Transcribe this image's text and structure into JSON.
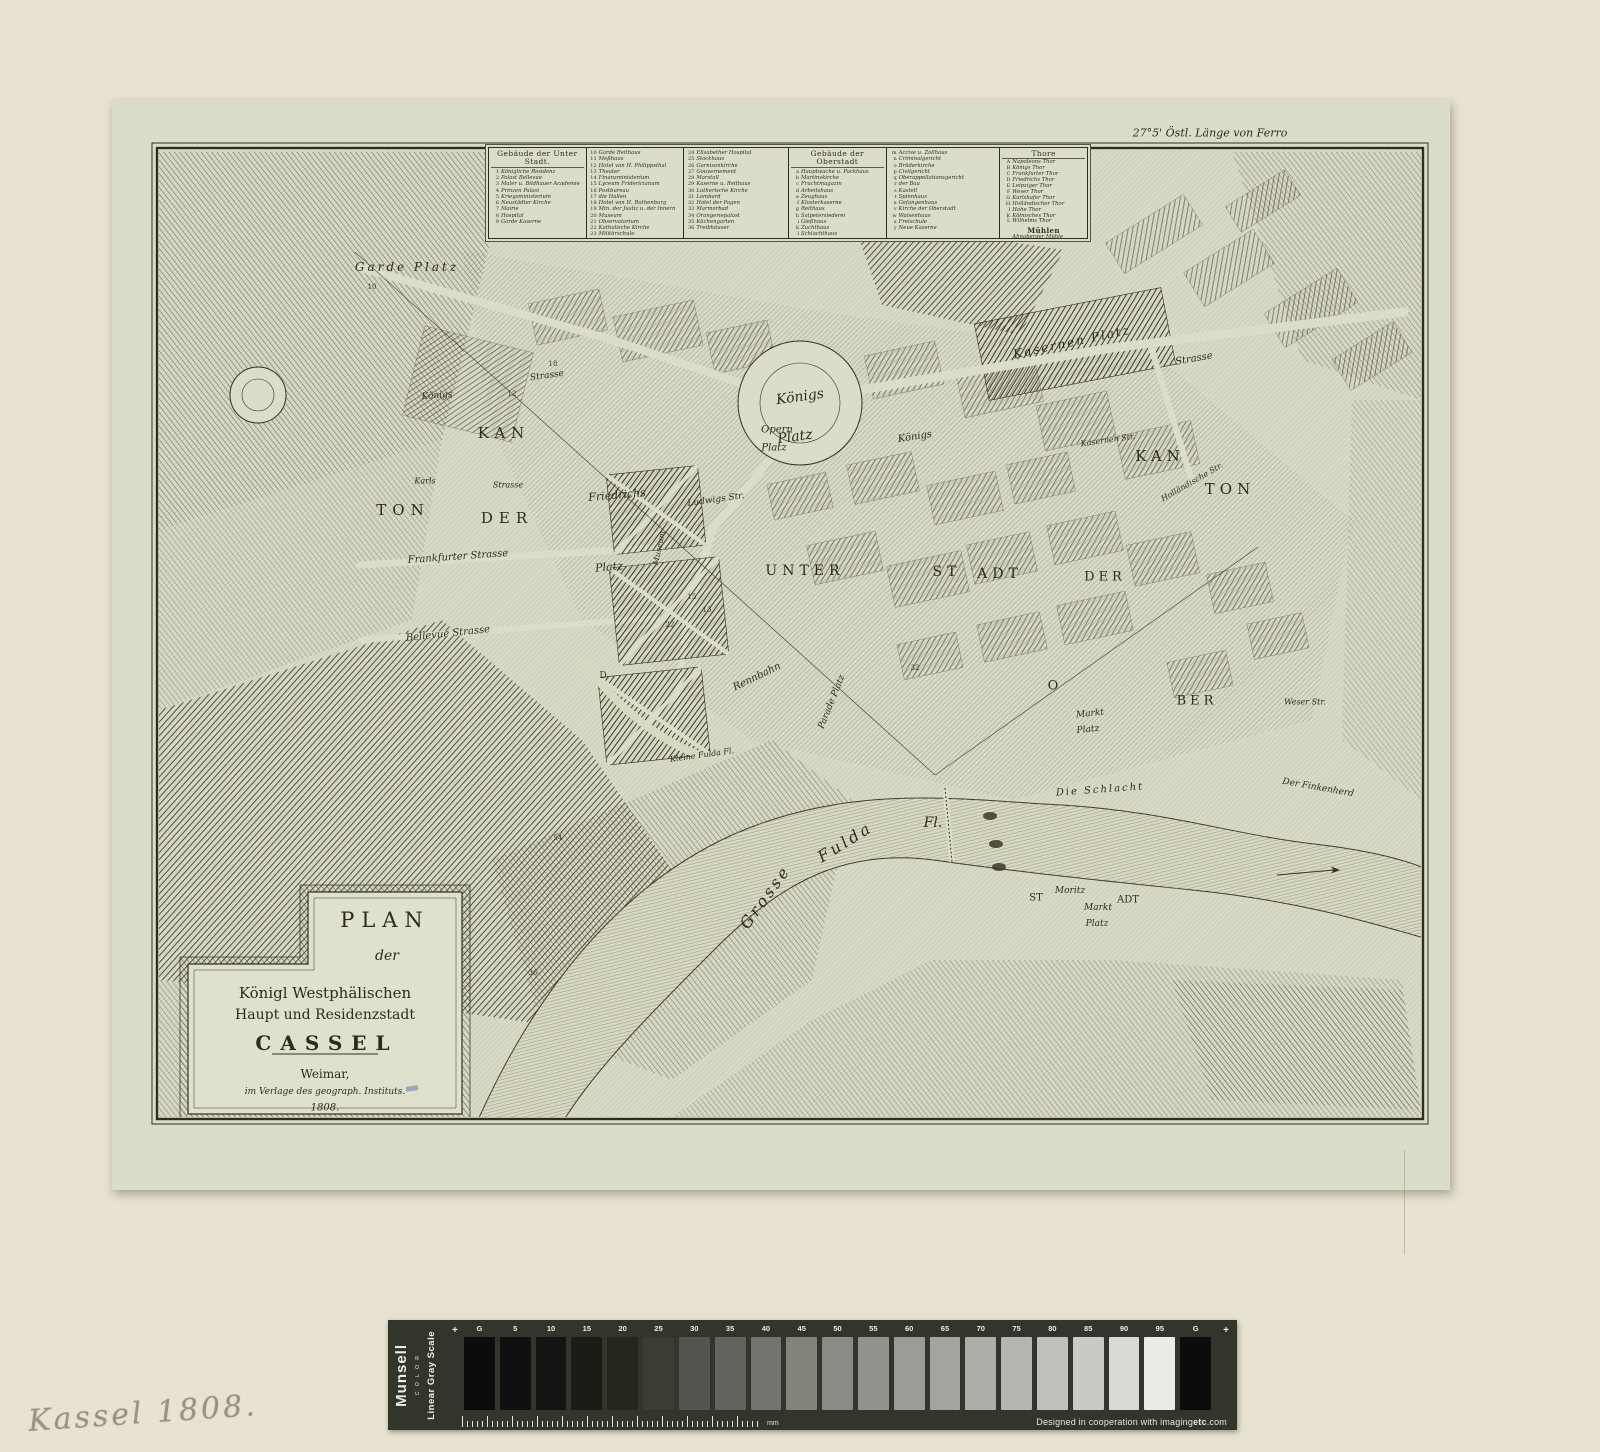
{
  "artifact": {
    "handwritten_note": "Kassel 1808.",
    "corner_note": "27°5' Östl. Länge von Ferro"
  },
  "legend": {
    "columns": [
      {
        "header": "Gebäude der Unter Stadt.",
        "items": [
          {
            "k": "1",
            "v": "Königliche Residenz"
          },
          {
            "k": "2",
            "v": "Palast Bellevue"
          },
          {
            "k": "3",
            "v": "Maler u. Bildhauer Academie"
          },
          {
            "k": "4",
            "v": "Prinzen Palast"
          },
          {
            "k": "5",
            "v": "Kriegsministerium"
          },
          {
            "k": "6",
            "v": "Neustädter Kirche"
          },
          {
            "k": "7",
            "v": "Mairie"
          },
          {
            "k": "8",
            "v": "Hospital"
          },
          {
            "k": "9",
            "v": "Garde Kaserne"
          }
        ]
      },
      {
        "header": "",
        "items": [
          {
            "k": "10",
            "v": "Garde Reithaus"
          },
          {
            "k": "11",
            "v": "Meßhaus"
          },
          {
            "k": "12",
            "v": "Hotel von H. Philippsthal"
          },
          {
            "k": "13",
            "v": "Theater"
          },
          {
            "k": "14",
            "v": "Finanzministerium"
          },
          {
            "k": "15",
            "v": "Lyceum Fridericianum"
          },
          {
            "k": "16",
            "v": "Postbureau"
          },
          {
            "k": "17",
            "v": "die Hallen"
          },
          {
            "k": "18",
            "v": "Hotel von H. Rothenburg"
          },
          {
            "k": "19",
            "v": "Min. der Justiz u. der Innern"
          },
          {
            "k": "20",
            "v": "Museum"
          },
          {
            "k": "21",
            "v": "Observatorium"
          },
          {
            "k": "22",
            "v": "Katholische Kirche"
          },
          {
            "k": "23",
            "v": "Militärschule"
          }
        ]
      },
      {
        "header": "",
        "items": [
          {
            "k": "24",
            "v": "Elisabether Hospital"
          },
          {
            "k": "25",
            "v": "Stockhaus"
          },
          {
            "k": "26",
            "v": "Garnisonkirche"
          },
          {
            "k": "27",
            "v": "Gouvernement"
          },
          {
            "k": "28",
            "v": "Marstall"
          },
          {
            "k": "29",
            "v": "Kaserne u. Reithaus"
          },
          {
            "k": "30",
            "v": "Lutherische Kirche"
          },
          {
            "k": "31",
            "v": "Lombard"
          },
          {
            "k": "32",
            "v": "Hotel der Pagen"
          },
          {
            "k": "33",
            "v": "Marmorbad"
          },
          {
            "k": "34",
            "v": "Orangeriepalast"
          },
          {
            "k": "35",
            "v": "Küchengarten"
          },
          {
            "k": "36",
            "v": "Treibhäuser"
          }
        ]
      },
      {
        "header": "Gebäude der Oberstadt",
        "items": [
          {
            "k": "a",
            "v": "Hauptwache u. Packhaus"
          },
          {
            "k": "b",
            "v": "Martinskirche"
          },
          {
            "k": "c",
            "v": "Fruchtmagazin"
          },
          {
            "k": "d",
            "v": "Arbeitshaus"
          },
          {
            "k": "e",
            "v": "Zeughaus"
          },
          {
            "k": "f",
            "v": "Klosterkaserne"
          },
          {
            "k": "g",
            "v": "Reithaus"
          },
          {
            "k": "h",
            "v": "Salpetersiederei"
          },
          {
            "k": "i",
            "v": "Gießhaus"
          },
          {
            "k": "k",
            "v": "Zuchthaus"
          },
          {
            "k": "l",
            "v": "Schlachthaus"
          }
        ]
      },
      {
        "header": "",
        "items": [
          {
            "k": "m",
            "v": "Accise u. Zollhaus"
          },
          {
            "k": "n",
            "v": "Criminalgericht"
          },
          {
            "k": "o",
            "v": "Brüderkirche"
          },
          {
            "k": "p",
            "v": "Civilgericht"
          },
          {
            "k": "q",
            "v": "Oberappellationsgericht"
          },
          {
            "k": "r",
            "v": "der Bau"
          },
          {
            "k": "s",
            "v": "Kastell"
          },
          {
            "k": "t",
            "v": "Spinnhaus"
          },
          {
            "k": "u",
            "v": "Gefangenhaus"
          },
          {
            "k": "v",
            "v": "Kirche der Oberstadt"
          },
          {
            "k": "w",
            "v": "Waisenhaus"
          },
          {
            "k": "x",
            "v": "Freischule"
          },
          {
            "k": "y",
            "v": "Neue Kaserne"
          }
        ]
      },
      {
        "header": "Thore",
        "items": [
          {
            "k": "A",
            "v": "Napoleons Thor"
          },
          {
            "k": "B",
            "v": "Königs Thor"
          },
          {
            "k": "C",
            "v": "Frankfurter Thor"
          },
          {
            "k": "D",
            "v": "Friedrichs Thor"
          },
          {
            "k": "E",
            "v": "Leipziger Thor"
          },
          {
            "k": "F",
            "v": "Weser Thor"
          },
          {
            "k": "G",
            "v": "Karlshafer Thor"
          },
          {
            "k": "H",
            "v": "Holländischer Thor"
          },
          {
            "k": "I",
            "v": "Hohe Thor"
          },
          {
            "k": "K",
            "v": "Kölnisches Thor"
          },
          {
            "k": "L",
            "v": "Wilhelms Thor"
          }
        ],
        "subheader": "Mühlen",
        "subitems": [
          {
            "k": "",
            "v": "Ahnaberger Mühle"
          },
          {
            "k": "",
            "v": "Oberste Mühle"
          }
        ]
      }
    ]
  },
  "map_labels": [
    {
      "t": "27°5' Östl. Länge von Ferro",
      "x": 1098,
      "y": 33,
      "s": 11
    },
    {
      "t": "Garde Platz",
      "x": 295,
      "y": 167,
      "s": 12,
      "ls": 3
    },
    {
      "t": "Opern",
      "x": 665,
      "y": 330,
      "s": 10
    },
    {
      "t": "Platz",
      "x": 662,
      "y": 348,
      "s": 10
    },
    {
      "t": "Königs",
      "x": 688,
      "y": 297,
      "s": 14,
      "rot": -8
    },
    {
      "t": "Platz",
      "x": 683,
      "y": 337,
      "s": 14,
      "rot": -8
    },
    {
      "t": "Königs",
      "x": 803,
      "y": 337,
      "s": 10,
      "rot": -9
    },
    {
      "t": "Königs",
      "x": 325,
      "y": 296,
      "s": 9,
      "rot": -4
    },
    {
      "t": "Strasse",
      "x": 435,
      "y": 276,
      "s": 9,
      "rot": -8
    },
    {
      "t": "Strasse",
      "x": 1082,
      "y": 259,
      "s": 10,
      "rot": -10
    },
    {
      "t": "KAN",
      "x": 392,
      "y": 333,
      "s": 15,
      "ls": 6,
      "cls": "sc"
    },
    {
      "t": "TON",
      "x": 291,
      "y": 410,
      "s": 15,
      "ls": 6,
      "cls": "sc"
    },
    {
      "t": "DER",
      "x": 395,
      "y": 418,
      "s": 15,
      "ls": 6,
      "cls": "sc"
    },
    {
      "t": "Karls",
      "x": 313,
      "y": 381,
      "s": 8
    },
    {
      "t": "Strasse",
      "x": 396,
      "y": 385,
      "s": 8
    },
    {
      "t": "Friedrichs",
      "x": 505,
      "y": 395,
      "s": 11,
      "rot": -5
    },
    {
      "t": "Platz",
      "x": 497,
      "y": 467,
      "s": 11,
      "rot": -5
    },
    {
      "t": "Frankfurter Strasse",
      "x": 346,
      "y": 457,
      "s": 10,
      "rot": -4
    },
    {
      "t": "Bellevue Strasse",
      "x": 336,
      "y": 534,
      "s": 10,
      "rot": -6
    },
    {
      "t": "Ludwigs Str.",
      "x": 604,
      "y": 400,
      "s": 9,
      "rot": -8
    },
    {
      "t": "Museum",
      "x": 547,
      "y": 448,
      "s": 8,
      "rot": -78
    },
    {
      "t": "UNTER",
      "x": 693,
      "y": 471,
      "s": 14,
      "ls": 5,
      "cls": "sc"
    },
    {
      "t": "ST",
      "x": 835,
      "y": 472,
      "s": 14,
      "ls": 5,
      "cls": "sc"
    },
    {
      "t": "ADT",
      "x": 888,
      "y": 474,
      "s": 14,
      "ls": 5,
      "cls": "sc"
    },
    {
      "t": "KAN",
      "x": 1048,
      "y": 356,
      "s": 15,
      "ls": 5,
      "cls": "sc"
    },
    {
      "t": "TON",
      "x": 1118,
      "y": 389,
      "s": 15,
      "ls": 5,
      "cls": "sc"
    },
    {
      "t": "DER",
      "x": 993,
      "y": 477,
      "s": 13,
      "ls": 4,
      "cls": "sc"
    },
    {
      "t": "O",
      "x": 941,
      "y": 586,
      "s": 13,
      "cls": "sc"
    },
    {
      "t": "BER",
      "x": 1085,
      "y": 601,
      "s": 13,
      "ls": 4,
      "cls": "sc"
    },
    {
      "t": "Kasernen Platz",
      "x": 960,
      "y": 242,
      "s": 12,
      "rot": -12,
      "ls": 2
    },
    {
      "t": "Kasernen Str.",
      "x": 996,
      "y": 340,
      "s": 8,
      "rot": -8
    },
    {
      "t": "Holländische Str.",
      "x": 1080,
      "y": 382,
      "s": 8,
      "rot": -30
    },
    {
      "t": "Markt",
      "x": 978,
      "y": 614,
      "s": 9,
      "rot": -6
    },
    {
      "t": "Platz",
      "x": 976,
      "y": 630,
      "s": 9,
      "rot": -6
    },
    {
      "t": "Weser Str.",
      "x": 1193,
      "y": 602,
      "s": 8
    },
    {
      "t": "Die Schlacht",
      "x": 988,
      "y": 690,
      "s": 10,
      "rot": -4,
      "ls": 2
    },
    {
      "t": "Der Finkenherd",
      "x": 1206,
      "y": 688,
      "s": 9,
      "rot": 10
    },
    {
      "t": "Grosse",
      "x": 653,
      "y": 797,
      "s": 16,
      "rot": -54,
      "ls": 3
    },
    {
      "t": "Fulda",
      "x": 733,
      "y": 742,
      "s": 16,
      "rot": -32,
      "ls": 3
    },
    {
      "t": "Fl.",
      "x": 821,
      "y": 723,
      "s": 14
    },
    {
      "t": "Kleine Fulda Fl.",
      "x": 590,
      "y": 655,
      "s": 8,
      "rot": -8
    },
    {
      "t": "Rennbahn",
      "x": 645,
      "y": 577,
      "s": 10,
      "rot": -26
    },
    {
      "t": "Parade Platz",
      "x": 720,
      "y": 602,
      "s": 9,
      "rot": -68
    },
    {
      "t": "Moritz",
      "x": 958,
      "y": 791,
      "s": 9
    },
    {
      "t": "ST",
      "x": 924,
      "y": 798,
      "s": 10,
      "cls": "sc"
    },
    {
      "t": "ADT",
      "x": 1016,
      "y": 800,
      "s": 10,
      "cls": "sc"
    },
    {
      "t": "Markt",
      "x": 986,
      "y": 808,
      "s": 9
    },
    {
      "t": "Platz",
      "x": 985,
      "y": 824,
      "s": 9
    },
    {
      "t": "10",
      "x": 260,
      "y": 187,
      "s": 7,
      "cls": "num"
    },
    {
      "t": "18",
      "x": 441,
      "y": 264,
      "s": 7,
      "cls": "num"
    },
    {
      "t": "12",
      "x": 400,
      "y": 294,
      "s": 7,
      "cls": "num"
    },
    {
      "t": "15",
      "x": 580,
      "y": 497,
      "s": 7,
      "cls": "num"
    },
    {
      "t": "13",
      "x": 595,
      "y": 510,
      "s": 7,
      "cls": "num"
    },
    {
      "t": "22",
      "x": 558,
      "y": 525,
      "s": 7,
      "cls": "num"
    },
    {
      "t": "32",
      "x": 803,
      "y": 568,
      "s": 7,
      "cls": "num"
    },
    {
      "t": "54",
      "x": 446,
      "y": 738,
      "s": 7,
      "cls": "num"
    },
    {
      "t": "36",
      "x": 421,
      "y": 873,
      "s": 7,
      "cls": "num"
    },
    {
      "t": "D",
      "x": 491,
      "y": 576,
      "s": 9,
      "cls": "num"
    },
    {
      "t": "PLAN",
      "x": 273,
      "y": 820,
      "s": 21,
      "ls": 7,
      "cls": "rom"
    },
    {
      "t": "der",
      "x": 275,
      "y": 856,
      "s": 14
    },
    {
      "t": "Königl Westphälischen",
      "x": 213,
      "y": 893,
      "s": 15,
      "cls": "rom"
    },
    {
      "t": "Haupt und Residenzstadt",
      "x": 213,
      "y": 915,
      "s": 14,
      "cls": "rom"
    },
    {
      "t": "CASSEL",
      "x": 215,
      "y": 943,
      "s": 20,
      "ls": 9,
      "cls": "rom bold"
    },
    {
      "t": "Weimar,",
      "x": 213,
      "y": 974,
      "s": 12,
      "cls": "rom"
    },
    {
      "t": "im Verlage des geograph. Instituts.",
      "x": 213,
      "y": 992,
      "s": 9
    },
    {
      "t": "1808.",
      "x": 213,
      "y": 1008,
      "s": 10
    }
  ],
  "gray_scale": {
    "brand": "Munsell",
    "brand_sub": "C O L O R",
    "scale_name": "Linear Gray Scale",
    "plus_mark": "+",
    "ruler_unit": "mm",
    "credit_prefix": "Designed in cooperation with imaging",
    "credit_bold": "etc",
    "credit_suffix": ".com",
    "patches": [
      {
        "label": "G",
        "hex": "#0c0c0c"
      },
      {
        "label": "5",
        "hex": "#101010"
      },
      {
        "label": "10",
        "hex": "#141412"
      },
      {
        "label": "15",
        "hex": "#1c1c17"
      },
      {
        "label": "20",
        "hex": "#26261f"
      },
      {
        "label": "25",
        "hex": "#3c3c33"
      },
      {
        "label": "30",
        "hex": "#55554f"
      },
      {
        "label": "35",
        "hex": "#63635d"
      },
      {
        "label": "40",
        "hex": "#74746e"
      },
      {
        "label": "45",
        "hex": "#83837b"
      },
      {
        "label": "50",
        "hex": "#8b8b85"
      },
      {
        "label": "55",
        "hex": "#93938d"
      },
      {
        "label": "60",
        "hex": "#9c9c96"
      },
      {
        "label": "65",
        "hex": "#a5a59f"
      },
      {
        "label": "70",
        "hex": "#adada7"
      },
      {
        "label": "75",
        "hex": "#b5b5b1"
      },
      {
        "label": "80",
        "hex": "#bfbfbb"
      },
      {
        "label": "85",
        "hex": "#c9c9c5"
      },
      {
        "label": "90",
        "hex": "#d9d9d5"
      },
      {
        "label": "95",
        "hex": "#ebebe7"
      },
      {
        "label": "G",
        "hex": "#0c0c0c"
      }
    ]
  }
}
